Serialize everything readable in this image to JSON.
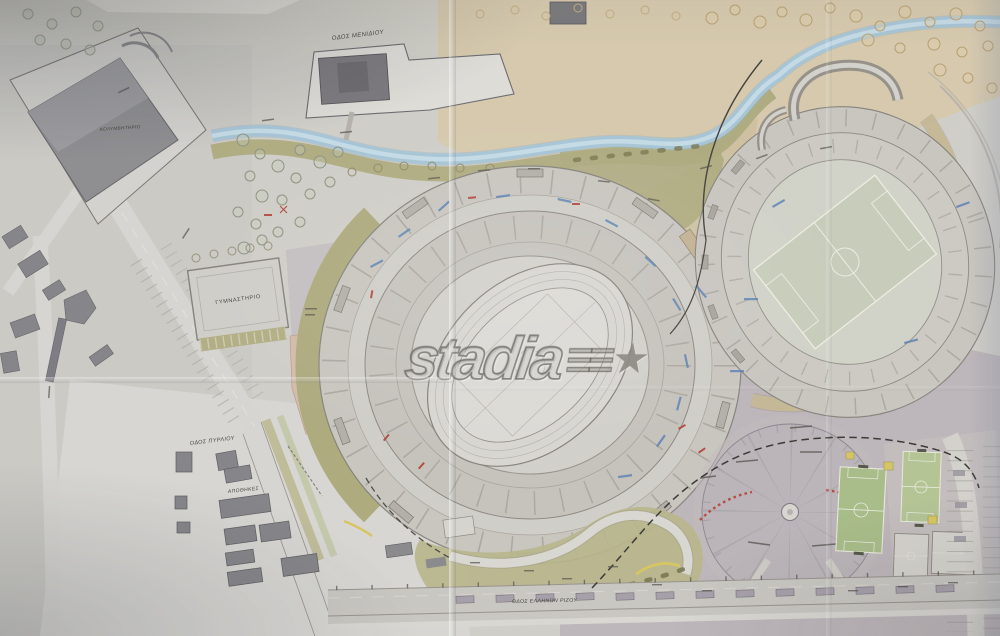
{
  "watermark": {
    "text": "stadia",
    "emblem": "≡≡",
    "star": "★"
  },
  "labels": {
    "road_top": "ΟΔΟΣ ΜΕΝΙΔΙΟΥ",
    "natatorium": "ΚΟΛΥΜΒΗΤΗΡΙΟ",
    "gymnasium": "ΓΥΜΝΑΣΤΗΡΙΟ",
    "warehouses": "ΑΠΟΘΗΚΕΣ",
    "road_southwest": "ΟΔΟΣ ΠΥΡΛΙΟΥ",
    "road_bottom": "ΟΔΟΣ ΕΛΛΗΝΩΝ ΡΙΖΟΥ"
  },
  "colors": {
    "c-paper": "#d0cec8",
    "c-paper2": "#cbcac5",
    "c-tan": "#d6c9ae",
    "c-stream": "#a7c5d6",
    "c-olive": "#aeab7f",
    "c-olive2": "#b9b68c",
    "c-mauve": "#bdb6ba",
    "c-pink": "#d5b9a6",
    "c-green": "#a9bd8a",
    "c-green2": "#b4c495",
    "c-bldg": "#86868a",
    "c-red": "#b2423a",
    "c-blue": "#5d83b5",
    "c-yellow": "#d6c565"
  }
}
